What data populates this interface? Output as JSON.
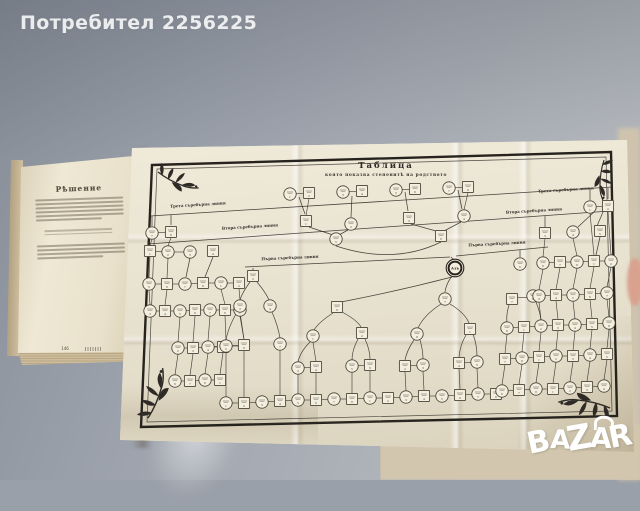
{
  "watermark": {
    "user_label": "Потребител 2256225"
  },
  "logo": {
    "brand": "BAZAR",
    "letters": [
      "B",
      "A",
      "Z",
      "A",
      "R"
    ]
  },
  "left_page": {
    "heading": "Рѣшение",
    "page_number": "146"
  },
  "foldout": {
    "title": "Таблица",
    "subtitle": "която показва степенитѣ на родството",
    "center_label": "Азъ"
  },
  "colors": {
    "ink": "#35302a",
    "paper": "#eae4d3",
    "node_fill": "#f3eedd",
    "background_gray": "#9aa0a9",
    "surface_beige": "#d2c6ae",
    "watermark_white": "#ffffff"
  },
  "diagram": {
    "line_labels": [
      {
        "text": "Трета съребърна линия",
        "x": 198,
        "y": 206,
        "rot": -3.5
      },
      {
        "text": "Втора съребърна линия",
        "x": 250,
        "y": 228,
        "rot": -3.5
      },
      {
        "text": "Първа съребърна линия",
        "x": 290,
        "y": 259,
        "rot": -2.5
      },
      {
        "text": "Трета съребърна линия",
        "x": 566,
        "y": 191,
        "rot": -3.5
      },
      {
        "text": "Втора съребърна линия",
        "x": 534,
        "y": 212,
        "rot": -3.5
      },
      {
        "text": "Първа съребърна линия",
        "x": 497,
        "y": 245,
        "rot": -3
      }
    ],
    "center": {
      "x": 455,
      "y": 268
    },
    "nodes": [
      [
        "c",
        290,
        194
      ],
      [
        "s",
        309,
        193
      ],
      [
        "c",
        343,
        192
      ],
      [
        "s",
        362,
        191
      ],
      [
        "c",
        396,
        190
      ],
      [
        "s",
        415,
        189
      ],
      [
        "c",
        449,
        188
      ],
      [
        "s",
        468,
        187
      ],
      [
        "s",
        306,
        221
      ],
      [
        "c",
        351,
        224
      ],
      [
        "s",
        409,
        218
      ],
      [
        "c",
        464,
        216
      ],
      [
        "c",
        336,
        239
      ],
      [
        "s",
        441,
        236
      ],
      [
        "c",
        152,
        233
      ],
      [
        "s",
        171,
        232
      ],
      [
        "s",
        150,
        251
      ],
      [
        "c",
        168,
        252
      ],
      [
        "c",
        190,
        252
      ],
      [
        "s",
        213,
        251
      ],
      [
        "c",
        149,
        284
      ],
      [
        "s",
        167,
        284
      ],
      [
        "c",
        185,
        284
      ],
      [
        "s",
        203,
        283
      ],
      [
        "c",
        221,
        283
      ],
      [
        "s",
        239,
        283
      ],
      [
        "c",
        150,
        311
      ],
      [
        "s",
        165,
        311
      ],
      [
        "c",
        180,
        311
      ],
      [
        "s",
        195,
        310
      ],
      [
        "c",
        210,
        310
      ],
      [
        "s",
        225,
        310
      ],
      [
        "c",
        240,
        310
      ],
      [
        "c",
        178,
        348
      ],
      [
        "s",
        193,
        348
      ],
      [
        "c",
        208,
        347
      ],
      [
        "s",
        223,
        347
      ],
      [
        "c",
        175,
        381
      ],
      [
        "s",
        190,
        381
      ],
      [
        "c",
        205,
        380
      ],
      [
        "s",
        220,
        380
      ],
      [
        "s",
        253,
        276
      ],
      [
        "c",
        240,
        306
      ],
      [
        "c",
        270,
        306
      ],
      [
        "c",
        226,
        346
      ],
      [
        "s",
        244,
        345
      ],
      [
        "c",
        280,
        344
      ],
      [
        "s",
        337,
        307
      ],
      [
        "c",
        313,
        336
      ],
      [
        "s",
        362,
        333
      ],
      [
        "c",
        298,
        368
      ],
      [
        "s",
        316,
        367
      ],
      [
        "c",
        352,
        366
      ],
      [
        "s",
        370,
        365
      ],
      [
        "c",
        445,
        299
      ],
      [
        "c",
        417,
        334
      ],
      [
        "s",
        470,
        329
      ],
      [
        "s",
        405,
        366
      ],
      [
        "c",
        423,
        365
      ],
      [
        "s",
        459,
        363
      ],
      [
        "c",
        477,
        362
      ],
      [
        "c",
        520,
        264
      ],
      [
        "s",
        512,
        299
      ],
      [
        "c",
        533,
        296
      ],
      [
        "c",
        226,
        403
      ],
      [
        "s",
        244,
        403
      ],
      [
        "c",
        262,
        402
      ],
      [
        "s",
        280,
        401
      ],
      [
        "c",
        298,
        400
      ],
      [
        "s",
        316,
        400
      ],
      [
        "c",
        334,
        399
      ],
      [
        "s",
        352,
        399
      ],
      [
        "c",
        370,
        398
      ],
      [
        "s",
        388,
        398
      ],
      [
        "c",
        406,
        397
      ],
      [
        "s",
        424,
        396
      ],
      [
        "c",
        442,
        396
      ],
      [
        "s",
        460,
        395
      ],
      [
        "c",
        478,
        394
      ],
      [
        "s",
        496,
        394
      ],
      [
        "c",
        590,
        207
      ],
      [
        "s",
        608,
        206
      ],
      [
        "s",
        545,
        233
      ],
      [
        "c",
        573,
        232
      ],
      [
        "s",
        600,
        231
      ],
      [
        "c",
        543,
        263
      ],
      [
        "s",
        560,
        262
      ],
      [
        "c",
        577,
        262
      ],
      [
        "s",
        594,
        261
      ],
      [
        "c",
        611,
        261
      ],
      [
        "c",
        539,
        296
      ],
      [
        "s",
        556,
        295
      ],
      [
        "c",
        573,
        295
      ],
      [
        "s",
        590,
        294
      ],
      [
        "c",
        607,
        293
      ],
      [
        "c",
        507,
        328
      ],
      [
        "s",
        524,
        327
      ],
      [
        "c",
        541,
        326
      ],
      [
        "s",
        558,
        325
      ],
      [
        "c",
        575,
        325
      ],
      [
        "s",
        592,
        324
      ],
      [
        "c",
        609,
        323
      ],
      [
        "s",
        505,
        359
      ],
      [
        "c",
        522,
        358
      ],
      [
        "s",
        539,
        357
      ],
      [
        "c",
        556,
        356
      ],
      [
        "s",
        573,
        356
      ],
      [
        "c",
        590,
        355
      ],
      [
        "s",
        607,
        354
      ],
      [
        "c",
        502,
        391
      ],
      [
        "s",
        519,
        390
      ],
      [
        "c",
        536,
        389
      ],
      [
        "s",
        553,
        389
      ],
      [
        "c",
        570,
        388
      ],
      [
        "s",
        587,
        387
      ],
      [
        "c",
        604,
        386
      ]
    ],
    "edges": [
      [
        299,
        197,
        305,
        214
      ],
      [
        352,
        196,
        351,
        217
      ],
      [
        405,
        192,
        408,
        211
      ],
      [
        458,
        190,
        462,
        209
      ],
      [
        309,
        227,
        333,
        235
      ],
      [
        348,
        230,
        339,
        235
      ],
      [
        411,
        224,
        436,
        231
      ],
      [
        461,
        222,
        444,
        231
      ],
      [
        150,
        216,
        612,
        187
      ],
      [
        148,
        244,
        610,
        211
      ],
      [
        245,
        267,
        450,
        257
      ],
      [
        456,
        256,
        548,
        247
      ],
      [
        451,
        257,
        454,
        260
      ],
      [
        152,
        216,
        152,
        226
      ],
      [
        171,
        215,
        171,
        225
      ],
      [
        253,
        268,
        253,
        270
      ],
      [
        520,
        250,
        520,
        257
      ],
      [
        590,
        189,
        590,
        200
      ],
      [
        608,
        188,
        608,
        199
      ],
      [
        594,
        212,
        578,
        227
      ],
      [
        603,
        212,
        597,
        226
      ],
      [
        545,
        216,
        545,
        227
      ],
      [
        190,
        258,
        186,
        277
      ],
      [
        213,
        257,
        205,
        277
      ],
      [
        600,
        237,
        596,
        255
      ]
    ],
    "curves": [
      [
        336,
        246,
        394,
        265,
        441,
        242
      ],
      [
        452,
        277,
        398,
        291,
        341,
        302
      ],
      [
        452,
        276,
        446,
        284,
        445,
        292
      ],
      [
        333,
        313,
        319,
        322,
        314,
        330
      ],
      [
        342,
        312,
        357,
        320,
        361,
        327
      ],
      [
        441,
        304,
        424,
        315,
        418,
        328
      ],
      [
        450,
        304,
        465,
        313,
        469,
        323
      ],
      [
        414,
        340,
        407,
        350,
        405,
        360
      ],
      [
        420,
        340,
        423,
        350,
        423,
        359
      ],
      [
        466,
        335,
        460,
        345,
        459,
        357
      ],
      [
        473,
        334,
        477,
        345,
        477,
        356
      ],
      [
        310,
        342,
        300,
        352,
        298,
        362
      ],
      [
        358,
        339,
        352,
        350,
        352,
        360
      ],
      [
        365,
        339,
        370,
        350,
        370,
        359
      ],
      [
        250,
        282,
        242,
        293,
        240,
        300
      ],
      [
        257,
        282,
        266,
        293,
        269,
        300
      ],
      [
        237,
        312,
        228,
        328,
        226,
        340
      ],
      [
        272,
        312,
        278,
        326,
        280,
        338
      ],
      [
        509,
        305,
        506,
        315,
        507,
        322
      ],
      [
        536,
        302,
        540,
        312,
        541,
        320
      ]
    ]
  }
}
